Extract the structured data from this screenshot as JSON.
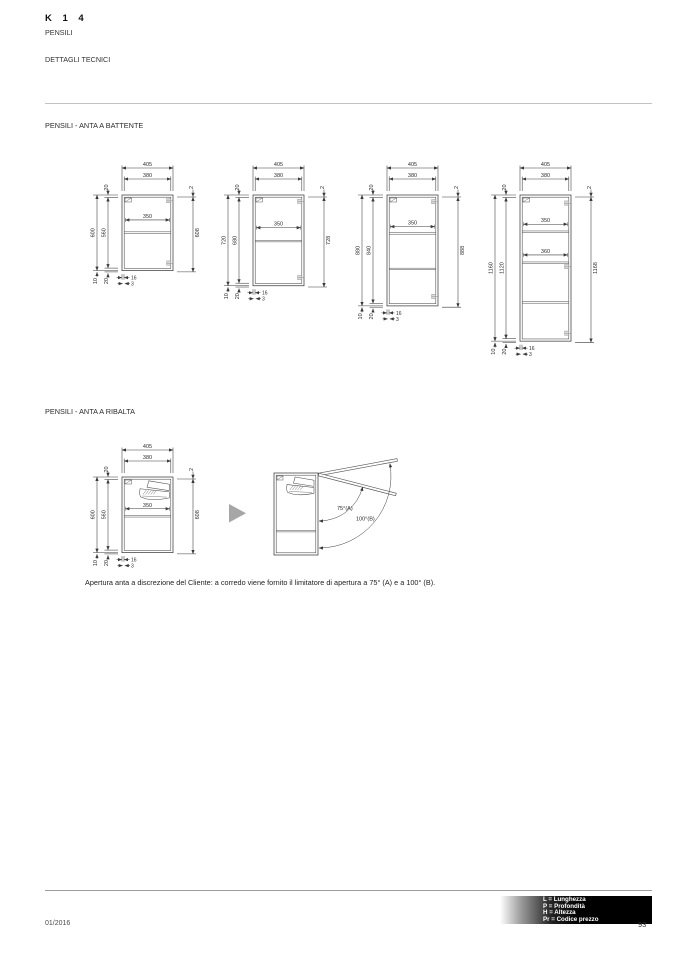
{
  "header": {
    "model": "K 1 4",
    "series": "PENSILI",
    "subtitle": "DETTAGLI TECNICI"
  },
  "sections": {
    "battente_title": "PENSILI - ANTA A BATTENTE",
    "ribalta_title": "PENSILI - ANTA A RIBALTA",
    "ribalta_caption": "Apertura anta a discrezione del Cliente: a corredo viene fornito il limitatore di apertura a 75° (A) e a 100° (B)."
  },
  "drawings": {
    "scale_px_per_mm": 0.126,
    "battente_cabinets": [
      {
        "h_mm": 600,
        "width_outer": "405",
        "width_inner": "380",
        "top_panel": "20",
        "height_total": "600",
        "height_inner": "560",
        "door_top_gap": "2",
        "door_height": "608",
        "inner_dims": [
          {
            "label": "350",
            "at": 0.33
          }
        ],
        "shelves": [
          0.487
        ],
        "hinges": [
          0.075,
          0.9
        ],
        "bottom_dims": {
          "overhang": "10",
          "panel": "20",
          "door_thickness": "16",
          "gap": "3"
        },
        "mechanism": false
      },
      {
        "h_mm": 720,
        "width_outer": "405",
        "width_inner": "380",
        "top_panel": "20",
        "height_total": "720",
        "height_inner": "680",
        "door_top_gap": "2",
        "door_height": "728",
        "inner_dims": [
          {
            "label": "350",
            "at": 0.36
          }
        ],
        "shelves": [
          0.5
        ],
        "hinges": [
          0.07,
          0.91
        ],
        "bottom_dims": {
          "overhang": "10",
          "panel": "20",
          "door_thickness": "16",
          "gap": "3"
        },
        "mechanism": false
      },
      {
        "h_mm": 880,
        "width_outer": "405",
        "width_inner": "380",
        "top_panel": "20",
        "height_total": "880",
        "height_inner": "840",
        "door_top_gap": "2",
        "door_height": "888",
        "inner_dims": [
          {
            "label": "350",
            "at": 0.285
          }
        ],
        "shelves": [
          0.34,
          0.66
        ],
        "hinges": [
          0.06,
          0.915
        ],
        "bottom_dims": {
          "overhang": "10",
          "panel": "20",
          "door_thickness": "16",
          "gap": "3"
        },
        "mechanism": false
      },
      {
        "h_mm": 1160,
        "width_outer": "405",
        "width_inner": "380",
        "top_panel": "20",
        "height_total": "1160",
        "height_inner": "1120",
        "door_top_gap": "2",
        "door_height": "1168",
        "inner_dims": [
          {
            "label": "350",
            "at": 0.2
          },
          {
            "label": "360",
            "at": 0.41
          }
        ],
        "shelves": [
          0.246,
          0.458,
          0.73
        ],
        "hinges": [
          0.055,
          0.49,
          0.945
        ],
        "bottom_dims": {
          "overhang": "10",
          "panel": "20",
          "door_thickness": "16",
          "gap": "3"
        },
        "mechanism": false
      }
    ],
    "ribalta_cabinet": {
      "h_mm": 600,
      "width_outer": "405",
      "width_inner": "380",
      "top_panel": "20",
      "height_total": "600",
      "height_inner": "560",
      "door_top_gap": "2",
      "door_height": "608",
      "inner_dims": [
        {
          "label": "350",
          "at": 0.42
        }
      ],
      "shelves": [
        0.51
      ],
      "hinges": [],
      "bottom_dims": {
        "overhang": "10",
        "panel": "20",
        "door_thickness": "16",
        "gap": "3"
      },
      "mechanism": true
    },
    "ribalta_open": {
      "angle_a": "75°(A)",
      "angle_b": "100°(B)"
    }
  },
  "footer": {
    "legend": [
      "L = Lunghezza",
      "P = Profondità",
      "H = Altezza",
      "Pr = Codice prezzo"
    ],
    "date": "01/2016",
    "page_number": "93"
  }
}
